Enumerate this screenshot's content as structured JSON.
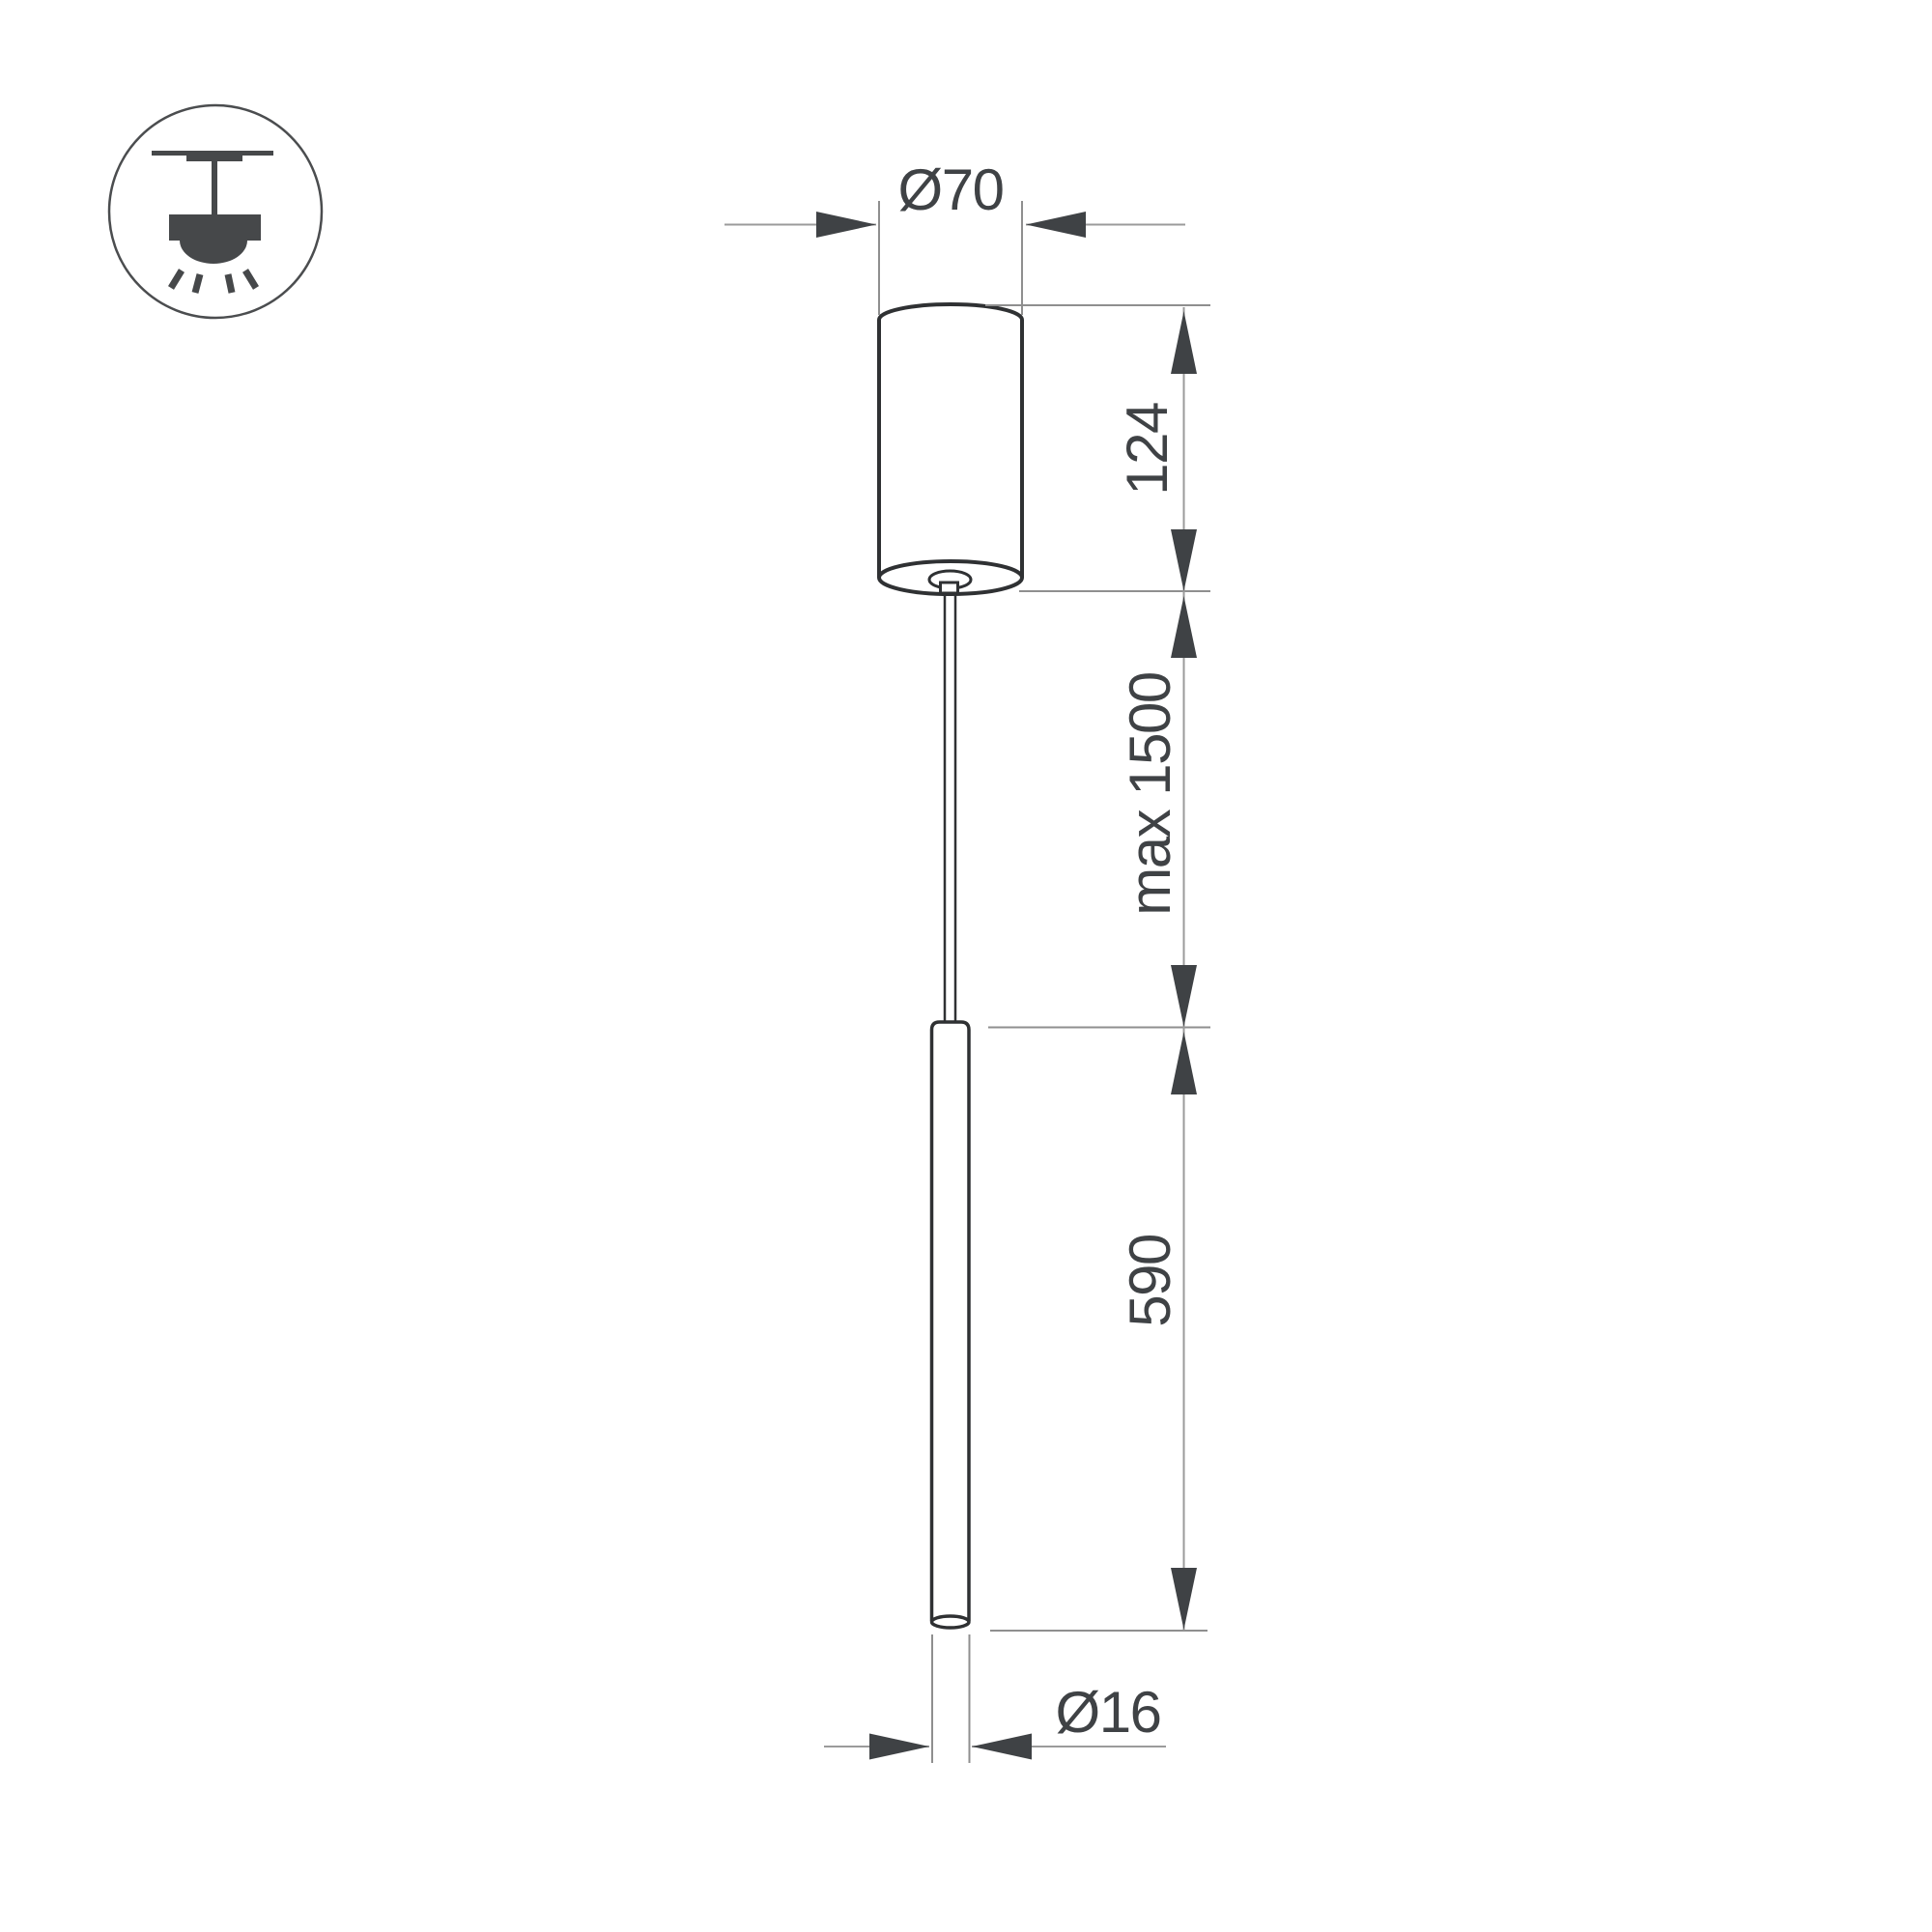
{
  "drawing": {
    "type": "pendant luminaire dimensional drawing",
    "labels": {
      "canopy_diameter": "Ø70",
      "canopy_height": "124",
      "suspension_length": "max 1500",
      "tube_length": "590",
      "tube_diameter": "Ø16"
    },
    "icons": {
      "ceiling_mount_icon": "surface ceiling-mounted pendant lamp symbol"
    },
    "colors": {
      "background": "#ffffff",
      "object_outline": "#2f3133",
      "dimension_line": "#9b9b9b",
      "arrow_and_text": "#3f4245",
      "icon_fill": "#46484a"
    }
  }
}
